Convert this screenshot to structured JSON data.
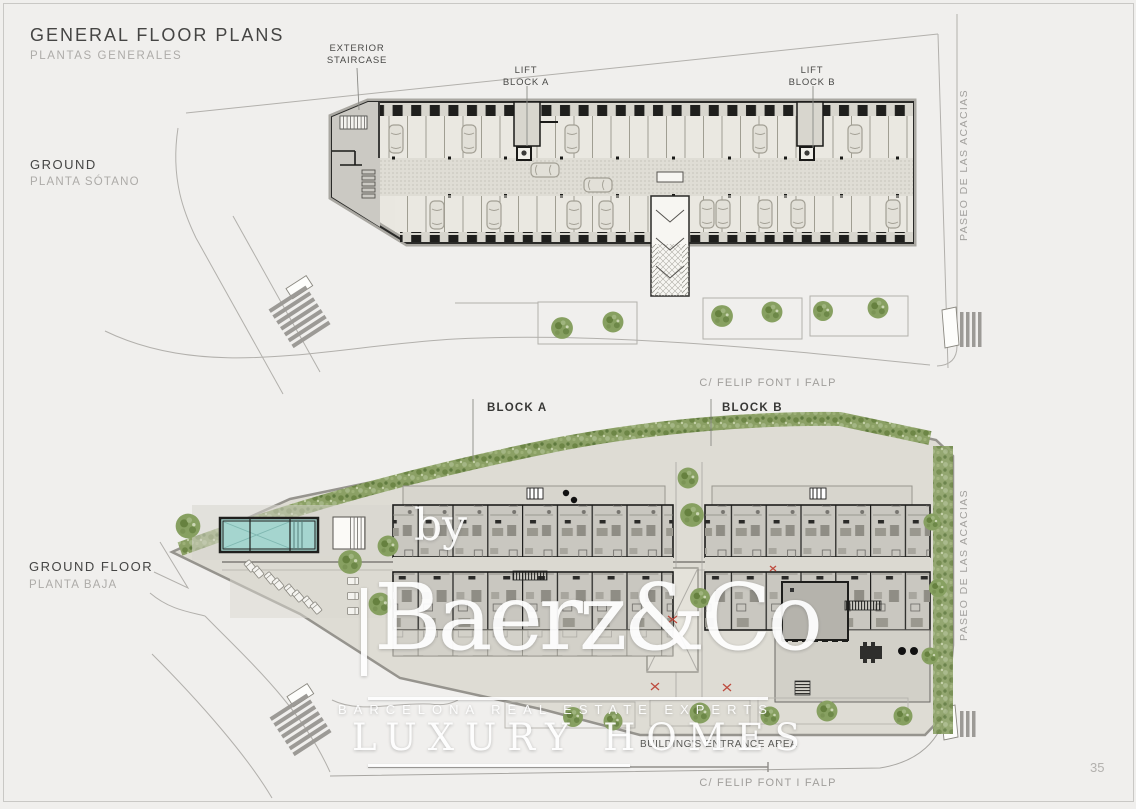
{
  "page": {
    "page_number": "35",
    "background_color": "#f0efed",
    "accent_green": "#8ba065",
    "pool_color": "#a5d5cf"
  },
  "header": {
    "title": "GENERAL FLOOR PLANS",
    "subtitle": "PLANTAS GENERALES"
  },
  "plans": {
    "ground": {
      "label": "GROUND",
      "label_es": "PLANTA SÓTANO"
    },
    "ground_floor": {
      "label": "GROUND FLOOR",
      "label_es": "PLANTA BAJA"
    }
  },
  "annotations": {
    "exterior_staircase": {
      "line1": "EXTERIOR",
      "line2": "STAIRCASE"
    },
    "lift_block_a": {
      "line1": "LIFT",
      "line2": "BLOCK A"
    },
    "lift_block_b": {
      "line1": "LIFT",
      "line2": "BLOCK B"
    },
    "block_a": "BLOCK A",
    "block_b": "BLOCK B",
    "buildings_entrance": "BUILDING'S ENTRANCE AREA"
  },
  "streets": {
    "felip_top": "C/ FELIP FONT I FALP",
    "felip_bottom": "C/ FELIP FONT I FALP",
    "paseo_top": "PASEO DE LAS ACACIAS",
    "paseo_bottom": "PASEO DE LAS ACACIAS"
  },
  "watermark": {
    "by": "by",
    "brand": "Baerz&Co",
    "tagline": "BARCELONA REAL ESTATE EXPERTS",
    "subbrand": "LUXURY HOMES"
  }
}
